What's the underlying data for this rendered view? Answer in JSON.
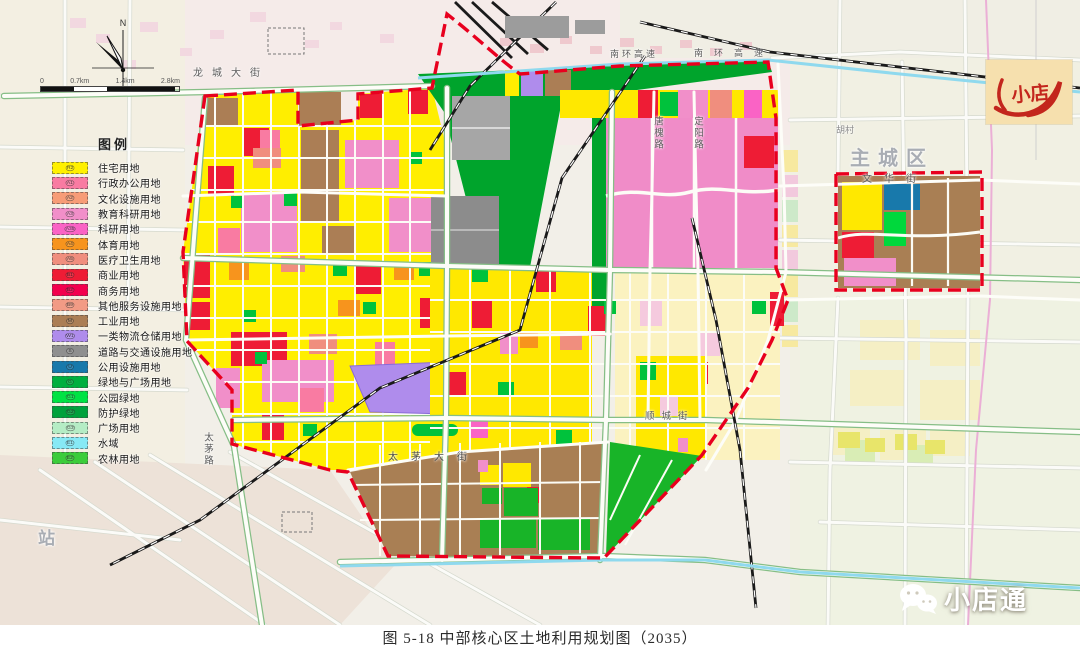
{
  "caption": "图 5-18 中部核心区土地利用规划图（2035）",
  "legend": {
    "title": "图例",
    "items": [
      {
        "code": "R2",
        "label": "住宅用地",
        "color": "#FFF000"
      },
      {
        "code": "A1",
        "label": "行政办公用地",
        "color": "#F97BA2"
      },
      {
        "code": "A2",
        "label": "文化设施用地",
        "color": "#F79C77"
      },
      {
        "code": "A3",
        "label": "教育科研用地",
        "color": "#F18FC9"
      },
      {
        "code": "A35",
        "label": "科研用地",
        "color": "#FA63C5"
      },
      {
        "code": "A4",
        "label": "体育用地",
        "color": "#F7941D"
      },
      {
        "code": "A5",
        "label": "医疗卫生用地",
        "color": "#F08E7E"
      },
      {
        "code": "B1",
        "label": "商业用地",
        "color": "#EE1C35"
      },
      {
        "code": "B2",
        "label": "商务用地",
        "color": "#F2004E"
      },
      {
        "code": "B9",
        "label": "其他服务设施用地",
        "color": "#F29B85"
      },
      {
        "code": "M",
        "label": "工业用地",
        "color": "#AB7E55"
      },
      {
        "code": "W1",
        "label": "一类物流仓储用地",
        "color": "#AF8CEC"
      },
      {
        "code": "S",
        "label": "道路与交通设施用地",
        "color": "#8F8F8F"
      },
      {
        "code": "U",
        "label": "公用设施用地",
        "color": "#1879AB"
      },
      {
        "code": "G",
        "label": "绿地与广场用地",
        "color": "#00AF3F"
      },
      {
        "code": "G1",
        "label": "公园绿地",
        "color": "#00E244"
      },
      {
        "code": "G2",
        "label": "防护绿地",
        "color": "#00A13C"
      },
      {
        "code": "G3",
        "label": "广场用地",
        "color": "#B5ECC5"
      },
      {
        "code": "E1",
        "label": "水域",
        "color": "#87E9F5"
      },
      {
        "code": "E2",
        "label": "农林用地",
        "color": "#3BCC3B"
      }
    ]
  },
  "compass": {
    "north_label": "N"
  },
  "scalebar": {
    "ticks": [
      "0",
      "0.7km",
      "1.4km",
      "2.8km"
    ]
  },
  "map_labels": {
    "longcheng_street": "龙城大街",
    "nanhuan_expressway_w": "南环高速",
    "nanhuan_expressway_e": "南环高速",
    "tanghuai_road": "唐槐路",
    "dingyang_road": "定阳路",
    "taimao_road": "太茅路",
    "taimao_street": "太茅大街",
    "shuncheng_street": "顺城街",
    "wenhua_street": "文华街",
    "main_city_area": "主城区",
    "station": "站",
    "hu_village": "胡村"
  },
  "stamp": {
    "text": "小店"
  },
  "watermark": {
    "text": "小店通"
  },
  "boundary_color": "#E8001E"
}
